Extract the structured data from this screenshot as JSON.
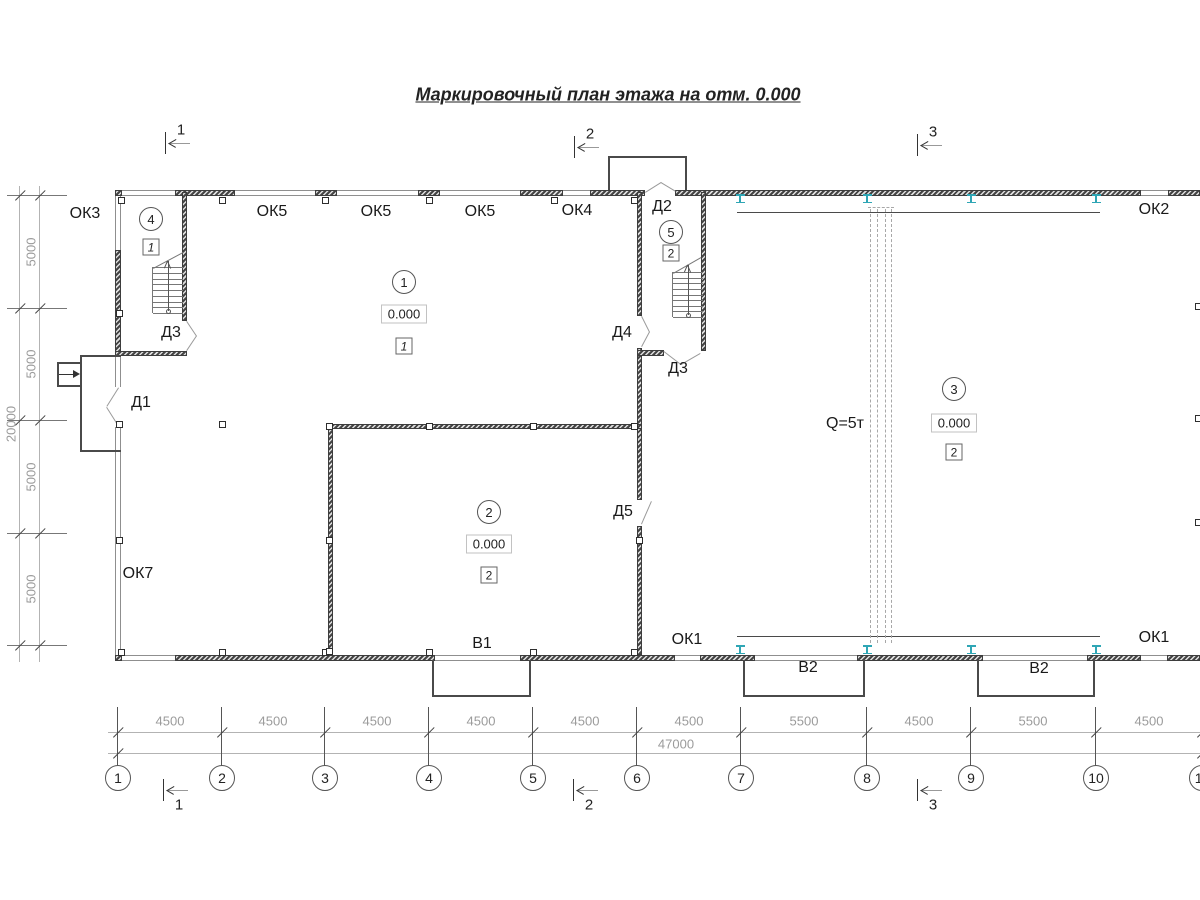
{
  "title": {
    "text": "Маркировочный план этажа на отм. 0.000",
    "x": 608,
    "y": 95
  },
  "colors": {
    "ink": "#333333",
    "dim_text": "#9b9b9b",
    "dim_line": "#b3b3b3",
    "grid_line": "#555555",
    "teal_ibeam": "#2fa6b5",
    "thin_line": "#8f8f8f",
    "outline": "#4a4a4a",
    "stair": "#777777",
    "crane_dash": "#a8a8a8",
    "door": "#9a9a9a"
  },
  "section_markers": {
    "top": [
      {
        "label": "1",
        "x": 166,
        "y": 143
      },
      {
        "label": "2",
        "x": 575,
        "y": 147
      },
      {
        "label": "3",
        "x": 918,
        "y": 145
      }
    ],
    "bottom": [
      {
        "label": "1",
        "x": 164,
        "y": 790
      },
      {
        "label": "2",
        "x": 574,
        "y": 790
      },
      {
        "label": "3",
        "x": 918,
        "y": 790
      }
    ]
  },
  "plan_labels": [
    {
      "text": "ОК3",
      "x": 85,
      "y": 214
    },
    {
      "text": "ОК5",
      "x": 272,
      "y": 212
    },
    {
      "text": "ОК5",
      "x": 376,
      "y": 212
    },
    {
      "text": "ОК5",
      "x": 480,
      "y": 212
    },
    {
      "text": "ОК4",
      "x": 577,
      "y": 211
    },
    {
      "text": "Д2",
      "x": 662,
      "y": 207
    },
    {
      "text": "ОК2",
      "x": 1154,
      "y": 210
    },
    {
      "text": "Д3",
      "x": 171,
      "y": 333
    },
    {
      "text": "Д4",
      "x": 622,
      "y": 333
    },
    {
      "text": "Д3",
      "x": 678,
      "y": 369
    },
    {
      "text": "Д1",
      "x": 141,
      "y": 403
    },
    {
      "text": "Д5",
      "x": 623,
      "y": 512
    },
    {
      "text": "ОК7",
      "x": 138,
      "y": 574
    },
    {
      "text": "В1",
      "x": 482,
      "y": 644
    },
    {
      "text": "ОК1",
      "x": 687,
      "y": 640
    },
    {
      "text": "В2",
      "x": 808,
      "y": 668
    },
    {
      "text": "В2",
      "x": 1039,
      "y": 669
    },
    {
      "text": "ОК1",
      "x": 1154,
      "y": 638
    },
    {
      "text": "Q=5т",
      "x": 845,
      "y": 424
    }
  ],
  "room_markers": [
    {
      "num": "1",
      "cx": 404,
      "cy": 282,
      "elevation": "0.000",
      "elev_cy": 314,
      "type": "1",
      "type_cy": 346,
      "italic": true
    },
    {
      "num": "2",
      "cx": 489,
      "cy": 512,
      "elevation": "0.000",
      "elev_cy": 544,
      "type": "2",
      "type_cy": 575,
      "italic": false
    },
    {
      "num": "3",
      "cx": 954,
      "cy": 389,
      "elevation": "0.000",
      "elev_cy": 423,
      "type": "2",
      "type_cy": 452,
      "italic": false
    },
    {
      "num": "4",
      "cx": 151,
      "cy": 219,
      "elevation": null,
      "type": "1",
      "type_cy": 247,
      "italic": true
    },
    {
      "num": "5",
      "cx": 671,
      "cy": 232,
      "elevation": null,
      "type": "2",
      "type_cy": 253,
      "italic": false
    }
  ],
  "crane": {
    "rails": [
      {
        "x1": 737,
        "x2": 1100,
        "y": 212
      },
      {
        "x1": 737,
        "x2": 1100,
        "y": 636
      }
    ],
    "dashed_x": [
      871,
      878,
      886,
      892
    ],
    "dash_y1": 209,
    "dash_y2": 643,
    "cap": {
      "x1": 868,
      "x2": 894,
      "y": 207
    },
    "ibeams_x": [
      740,
      867,
      971,
      1096
    ],
    "ibeams_top_y": 194,
    "ibeams_bottom_y": 645
  },
  "dims_bottom": {
    "line1_y": 732,
    "line2_y": 753,
    "x1": 108,
    "x2": 1200,
    "segment_labels": [
      {
        "text": "4500",
        "x": 170
      },
      {
        "text": "4500",
        "x": 273
      },
      {
        "text": "4500",
        "x": 377
      },
      {
        "text": "4500",
        "x": 481
      },
      {
        "text": "4500",
        "x": 585
      },
      {
        "text": "4500",
        "x": 689
      },
      {
        "text": "5500",
        "x": 804
      },
      {
        "text": "4500",
        "x": 919
      },
      {
        "text": "5500",
        "x": 1033
      },
      {
        "text": "4500",
        "x": 1149
      }
    ],
    "label_y": 721,
    "total": {
      "text": "47000",
      "x": 676,
      "y": 744
    },
    "grid_axes": [
      {
        "label": "1",
        "x": 118
      },
      {
        "label": "2",
        "x": 222
      },
      {
        "label": "3",
        "x": 325
      },
      {
        "label": "4",
        "x": 429
      },
      {
        "label": "5",
        "x": 533
      },
      {
        "label": "6",
        "x": 637
      },
      {
        "label": "7",
        "x": 741
      },
      {
        "label": "8",
        "x": 867
      },
      {
        "label": "9",
        "x": 971
      },
      {
        "label": "10",
        "x": 1096
      },
      {
        "label": "11",
        "x": 1202
      }
    ],
    "axis_y1": 707,
    "axis_y2": 766,
    "bubble_cy": 778,
    "bubble_r": 12
  },
  "dims_left": {
    "line1_x": 20,
    "line2_x": 40,
    "y1": 186,
    "y2": 662,
    "rows": [
      195,
      308,
      420,
      533,
      645
    ],
    "segment_labels": [
      {
        "text": "5000",
        "x": 31,
        "y": 252
      },
      {
        "text": "5000",
        "x": 31,
        "y": 364
      },
      {
        "text": "5000",
        "x": 31,
        "y": 477
      },
      {
        "text": "5000",
        "x": 31,
        "y": 589
      }
    ],
    "total": {
      "text": "20000",
      "x": 11,
      "y": 424
    }
  },
  "plan": {
    "walls": [
      [
        115,
        190,
        7,
        6
      ],
      [
        175,
        190,
        60,
        6
      ],
      [
        315,
        190,
        22,
        6
      ],
      [
        418,
        190,
        22,
        6
      ],
      [
        520,
        190,
        43,
        6
      ],
      [
        590,
        190,
        55,
        6
      ],
      [
        675,
        190,
        466,
        6
      ],
      [
        1168,
        190,
        32,
        6
      ],
      [
        115,
        655,
        7,
        6
      ],
      [
        175,
        655,
        260,
        6
      ],
      [
        520,
        655,
        155,
        6
      ],
      [
        700,
        655,
        55,
        6
      ],
      [
        857,
        655,
        126,
        6
      ],
      [
        1087,
        655,
        54,
        6
      ],
      [
        1167,
        655,
        33,
        6
      ],
      [
        115,
        250,
        6,
        107
      ],
      [
        182,
        192,
        5,
        129
      ],
      [
        115,
        351,
        72,
        5
      ],
      [
        637,
        192,
        5,
        124
      ],
      [
        637,
        348,
        5,
        152
      ],
      [
        637,
        526,
        5,
        129
      ],
      [
        701,
        192,
        5,
        159
      ],
      [
        637,
        350,
        27,
        6
      ],
      [
        328,
        424,
        314,
        5
      ],
      [
        328,
        429,
        5,
        226
      ]
    ],
    "windows_h": [
      [
        122,
        190,
        53
      ],
      [
        235,
        190,
        80
      ],
      [
        337,
        190,
        81
      ],
      [
        440,
        190,
        80
      ],
      [
        563,
        190,
        27
      ],
      [
        1141,
        190,
        27
      ],
      [
        122,
        655,
        53
      ],
      [
        435,
        655,
        85
      ],
      [
        675,
        655,
        25
      ],
      [
        755,
        655,
        102
      ],
      [
        983,
        655,
        104
      ],
      [
        1141,
        655,
        26
      ]
    ],
    "windows_v": [
      [
        115,
        196,
        54
      ],
      [
        115,
        357,
        30
      ],
      [
        115,
        427,
        228
      ]
    ],
    "columns": [
      [
        121,
        200
      ],
      [
        222,
        200
      ],
      [
        325,
        200
      ],
      [
        429,
        200
      ],
      [
        554,
        200
      ],
      [
        634,
        200
      ],
      [
        121,
        652
      ],
      [
        222,
        652
      ],
      [
        325,
        652
      ],
      [
        429,
        652
      ],
      [
        533,
        652
      ],
      [
        634,
        652
      ],
      [
        119,
        313
      ],
      [
        119,
        424
      ],
      [
        119,
        540
      ],
      [
        329,
        426
      ],
      [
        429,
        426
      ],
      [
        533,
        426
      ],
      [
        634,
        426
      ],
      [
        329,
        540
      ],
      [
        329,
        651
      ],
      [
        639,
        540
      ],
      [
        222,
        424
      ],
      [
        1198,
        306
      ],
      [
        1198,
        418
      ],
      [
        1198,
        522
      ]
    ],
    "door_leaves": [
      [
        119,
        388,
        107,
        407
      ],
      [
        107,
        407,
        119,
        426
      ],
      [
        187,
        321,
        197,
        336
      ],
      [
        197,
        336,
        187,
        351
      ],
      [
        645,
        192,
        661,
        182
      ],
      [
        661,
        182,
        676,
        191
      ],
      [
        642,
        316,
        650,
        332
      ],
      [
        650,
        332,
        642,
        347
      ],
      [
        664,
        351,
        681,
        364
      ],
      [
        681,
        364,
        700,
        353
      ],
      [
        641,
        524,
        651,
        501
      ]
    ],
    "outlines": [
      {
        "name": "vestibule-outline",
        "x": 608,
        "y": 156,
        "w": 79,
        "h": 34,
        "sides": [
          "l",
          "t",
          "r"
        ]
      },
      {
        "name": "porch-outline",
        "x": 80,
        "y": 355,
        "w": 41,
        "h": 97,
        "sides": [
          "l",
          "t",
          "b"
        ]
      },
      {
        "name": "porch-step-outline",
        "x": 57,
        "y": 362,
        "w": 24,
        "h": 25,
        "sides": [
          "l",
          "t",
          "b"
        ]
      },
      {
        "name": "platform-outline",
        "x": 432,
        "y": 660,
        "w": 99,
        "h": 37,
        "sides": [
          "l",
          "r",
          "b"
        ]
      },
      {
        "name": "platform-outline",
        "x": 743,
        "y": 660,
        "w": 122,
        "h": 37,
        "sides": [
          "l",
          "r",
          "b"
        ]
      },
      {
        "name": "platform-outline",
        "x": 977,
        "y": 660,
        "w": 118,
        "h": 37,
        "sides": [
          "l",
          "r",
          "b"
        ]
      }
    ],
    "entrance_arrow": {
      "x1": 59,
      "y1": 374,
      "x2": 73,
      "y2": 374
    },
    "stairs": [
      {
        "x": 153,
        "y": 267,
        "w": 30,
        "h": 46,
        "steps": 8,
        "diag": [
          153,
          268,
          183,
          252
        ],
        "arrow_x": 168,
        "arrow_y1": 311,
        "arrow_y2": 261
      },
      {
        "x": 673,
        "y": 272,
        "w": 30,
        "h": 45,
        "steps": 8,
        "diag": [
          673,
          273,
          701,
          257
        ],
        "arrow_x": 688,
        "arrow_y1": 315,
        "arrow_y2": 265
      }
    ]
  }
}
